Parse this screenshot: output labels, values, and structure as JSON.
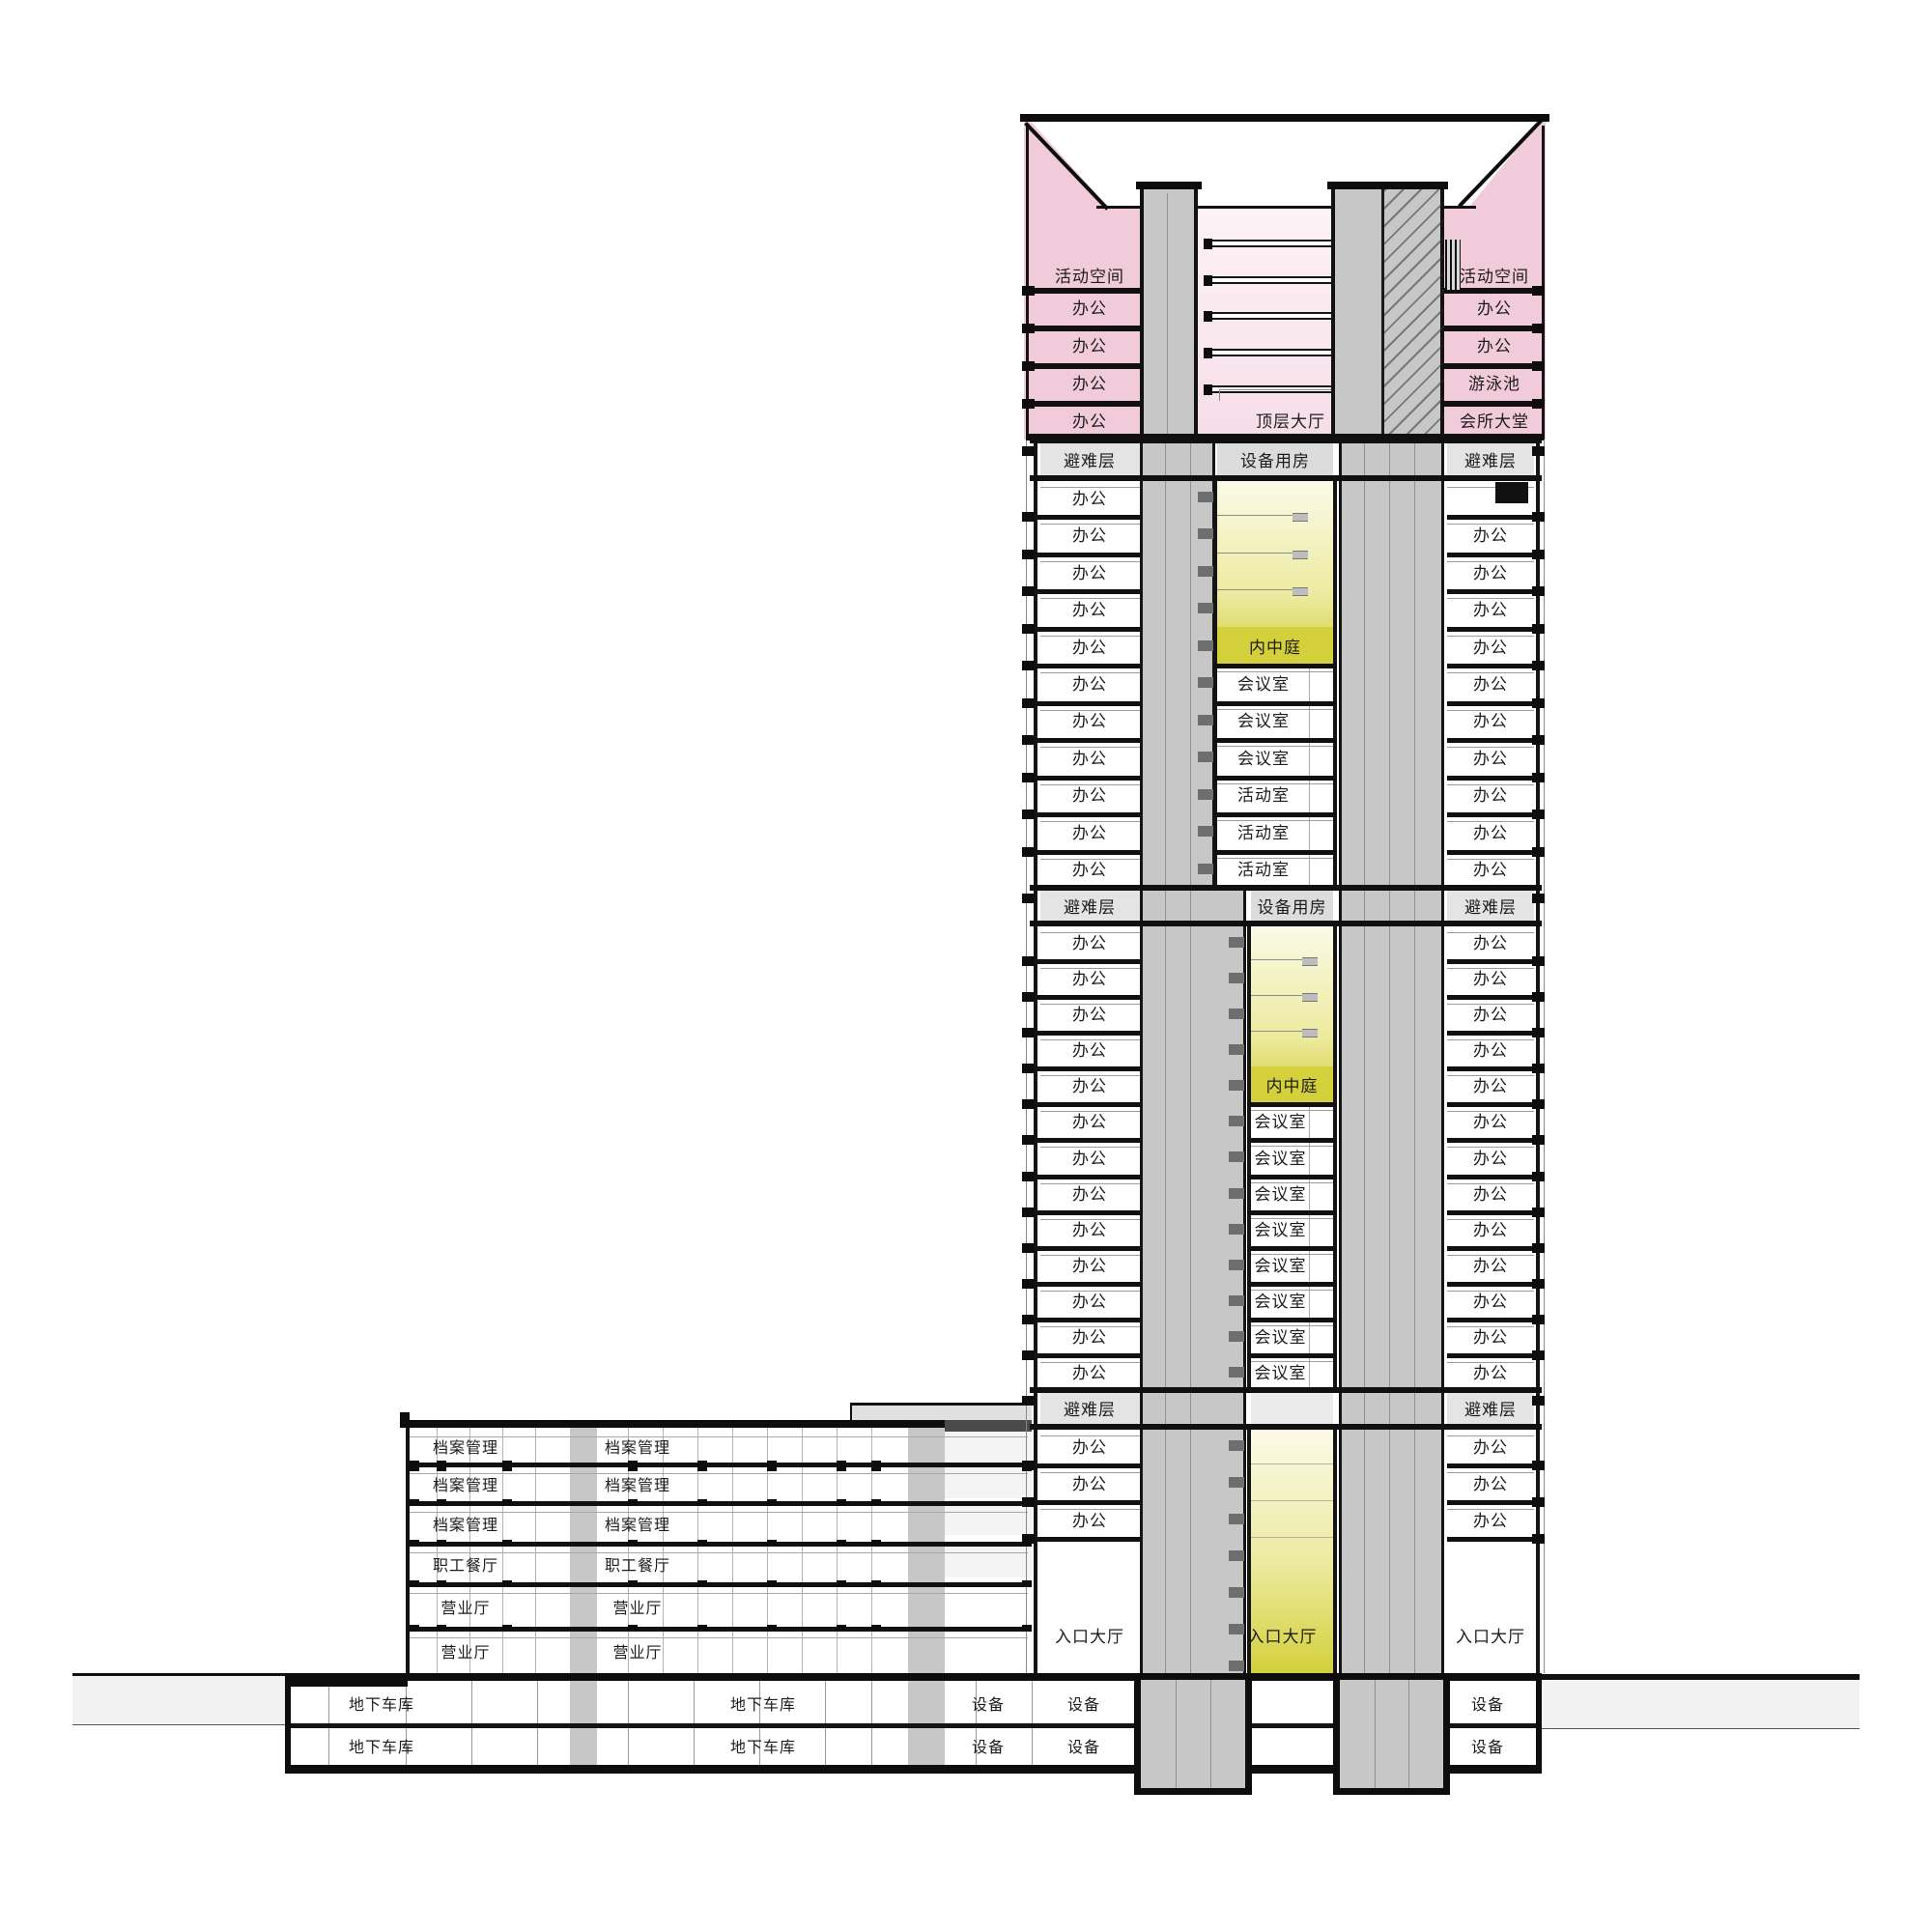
{
  "title": "高层建筑剖面图",
  "colors": {
    "pink": "#f1cbd9",
    "pink_pale": "#fdf3f7",
    "core_gray": "#c7c7c7",
    "core_gray_dark": "#b9b9b9",
    "refuge_gray": "#e4e4e4",
    "equip_gray": "#dcdcdc",
    "atrium_yellow": "#d3d03c",
    "atrium_mid": "#ecea9e",
    "atrium_pale": "#fbfae9",
    "ink": "#141414"
  },
  "tower": {
    "crown": {
      "left_rows": [
        "活动空间",
        "办公",
        "办公",
        "办公",
        "办公"
      ],
      "right_rows": [
        "活动空间",
        "办公",
        "办公",
        "游泳池",
        "会所大堂"
      ],
      "middle_hall": "顶层大厅"
    },
    "sections": [
      {
        "left_refuge": "避难层",
        "right_refuge": "避难层",
        "middle_band": "设备用房",
        "atrium": "内中庭",
        "left_rows": [
          "办公",
          "办公",
          "办公",
          "办公",
          "办公",
          "办公",
          "办公",
          "办公",
          "办公",
          "办公",
          "办公"
        ],
        "right_rows": [
          "",
          "办公",
          "办公",
          "办公",
          "办公",
          "办公",
          "办公",
          "办公",
          "办公",
          "办公",
          "办公"
        ],
        "middle_rooms": [
          "会议室",
          "会议室",
          "会议室",
          "活动室",
          "活动室",
          "活动室"
        ]
      },
      {
        "left_refuge": "避难层",
        "right_refuge": "避难层",
        "middle_band": "设备用房",
        "atrium": "内中庭",
        "left_rows": [
          "办公",
          "办公",
          "办公",
          "办公",
          "办公",
          "办公",
          "办公",
          "办公",
          "办公",
          "办公",
          "办公",
          "办公",
          "办公"
        ],
        "right_rows": [
          "办公",
          "办公",
          "办公",
          "办公",
          "办公",
          "办公",
          "办公",
          "办公",
          "办公",
          "办公",
          "办公",
          "办公",
          "办公"
        ],
        "middle_rooms": [
          "会议室",
          "会议室",
          "会议室",
          "会议室",
          "会议室",
          "会议室",
          "会议室",
          "会议室"
        ]
      },
      {
        "left_refuge": "避难层",
        "right_refuge": "避难层",
        "middle_band": "",
        "left_rows": [
          "办公",
          "办公",
          "办公"
        ],
        "right_rows": [
          "办公",
          "办公",
          "办公"
        ],
        "entrance_left": "入口大厅",
        "entrance_middle": "入口大厅",
        "entrance_right": "入口大厅"
      }
    ]
  },
  "podium": {
    "floors": [
      {
        "left": "档案管理",
        "middle": "档案管理"
      },
      {
        "left": "档案管理",
        "middle": "档案管理"
      },
      {
        "left": "档案管理",
        "middle": "档案管理"
      },
      {
        "left": "职工餐厅",
        "middle": "职工餐厅"
      },
      {
        "left": "营业厅",
        "middle": "营业厅"
      },
      {
        "left": "营业厅",
        "middle": "营业厅"
      }
    ]
  },
  "basement": {
    "garage": "地下车库",
    "equipment": "设备"
  }
}
